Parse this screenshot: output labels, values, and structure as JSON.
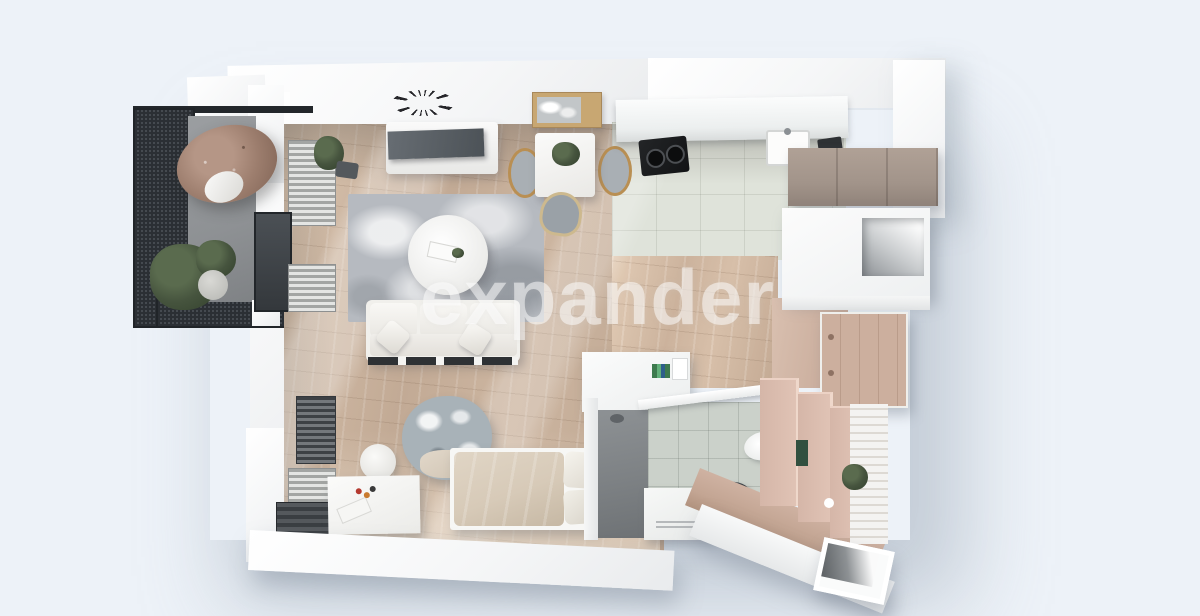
{
  "watermark": {
    "text": "expander"
  },
  "scene": {
    "type": "3d-floor-plan-render",
    "description": "Top-down 3D visualization of a studio apartment with balcony",
    "rooms": [
      "balcony",
      "living-room",
      "kitchen",
      "hallway",
      "sleeping-area",
      "bathroom"
    ],
    "furniture": {
      "balcony": [
        "hanging-egg-chair",
        "potted-plant",
        "mesh-railing"
      ],
      "living_room": [
        "wall-clock",
        "tv",
        "tv-console",
        "wall-art",
        "dining-table",
        "dining-chairs",
        "area-rug",
        "round-coffee-table",
        "sofa",
        "floor-plant"
      ],
      "kitchen": [
        "countertop",
        "cooktop",
        "sink",
        "taupe-cabinets",
        "open-shelf-niche"
      ],
      "hallway": [
        "wardrobe",
        "wooden-door-panel"
      ],
      "sleeping_area": [
        "bed",
        "pillows",
        "floral-armchair",
        "white-desk",
        "stool",
        "radiators"
      ],
      "bathroom": [
        "shower",
        "shower-bench",
        "wall-hung-toilet",
        "vessel-sink",
        "vanity-counter",
        "rose-tile-walls",
        "plant",
        "entry-door-opening"
      ]
    }
  },
  "colors": {
    "bg": "#edf2f8",
    "wall": "#f5f6f7",
    "woodFloor": "#c2aa95",
    "woodLight": "#d8c3ae",
    "kitchenTile": "#dfe3da",
    "bathTile": "#cbd1ca",
    "mesh": "#2b2f34",
    "balconyFloor": "#8e9194",
    "chairRattan": "#9d7e6e",
    "rug": "#b6bac0",
    "sofa": "#f1f0ec",
    "cabinetTaupe": "#a2948a",
    "doorWood": "#ccaf9e",
    "roseWall": "#d5b6a8",
    "roseFloor": "#c5a796",
    "showerFloor": "#7d8184",
    "duvet": "#d7cab8",
    "plant": "#46543e",
    "brass": "#b98f53",
    "dark": "#2e3134",
    "watermark": "rgba(255,255,255,0.52)"
  }
}
